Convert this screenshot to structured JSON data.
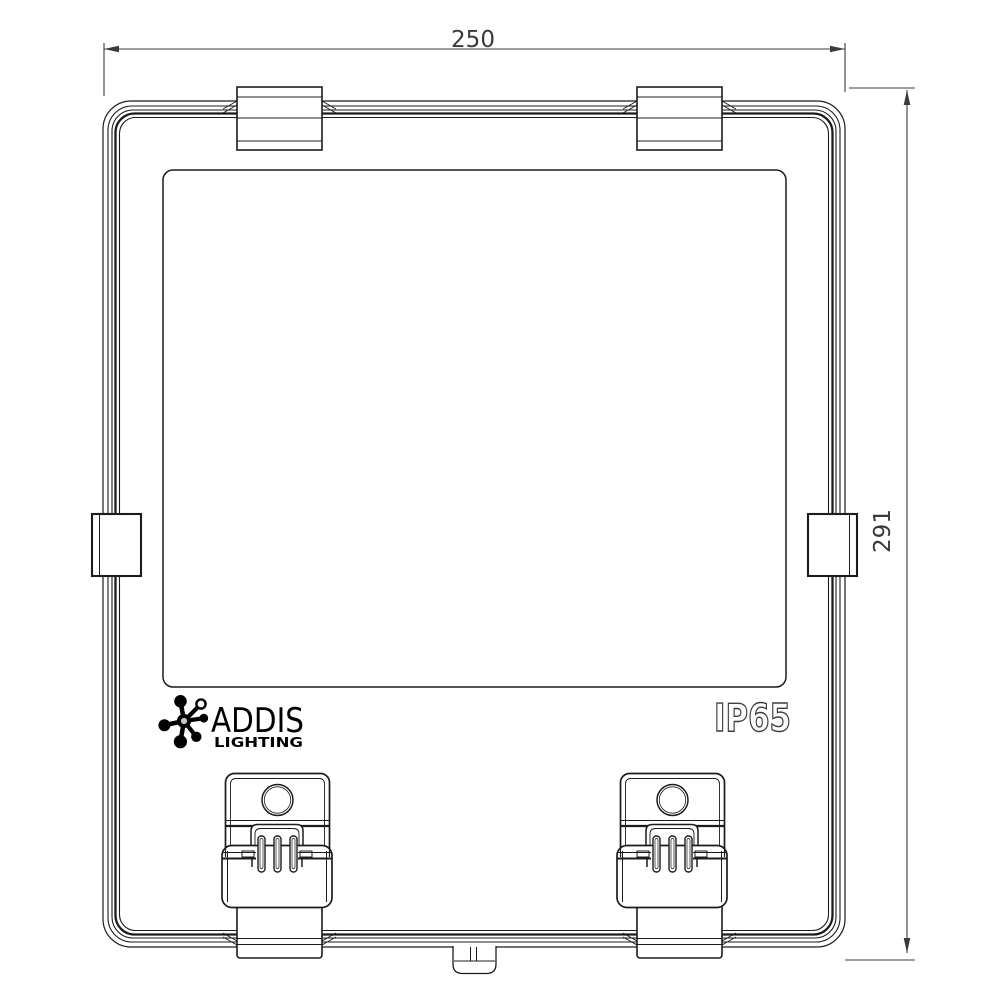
{
  "drawing": {
    "dimensions": {
      "width": {
        "label": "250"
      },
      "height": {
        "label": "291"
      }
    },
    "branding": {
      "name": "ADDIS",
      "subtitle": "LIGHTING",
      "logo_icon": "addis-star-icon"
    },
    "rating": {
      "label": "IP65"
    },
    "colors": {
      "line": "#1c1c1c",
      "dimension": "#3a3a3a",
      "background": "#ffffff"
    }
  }
}
